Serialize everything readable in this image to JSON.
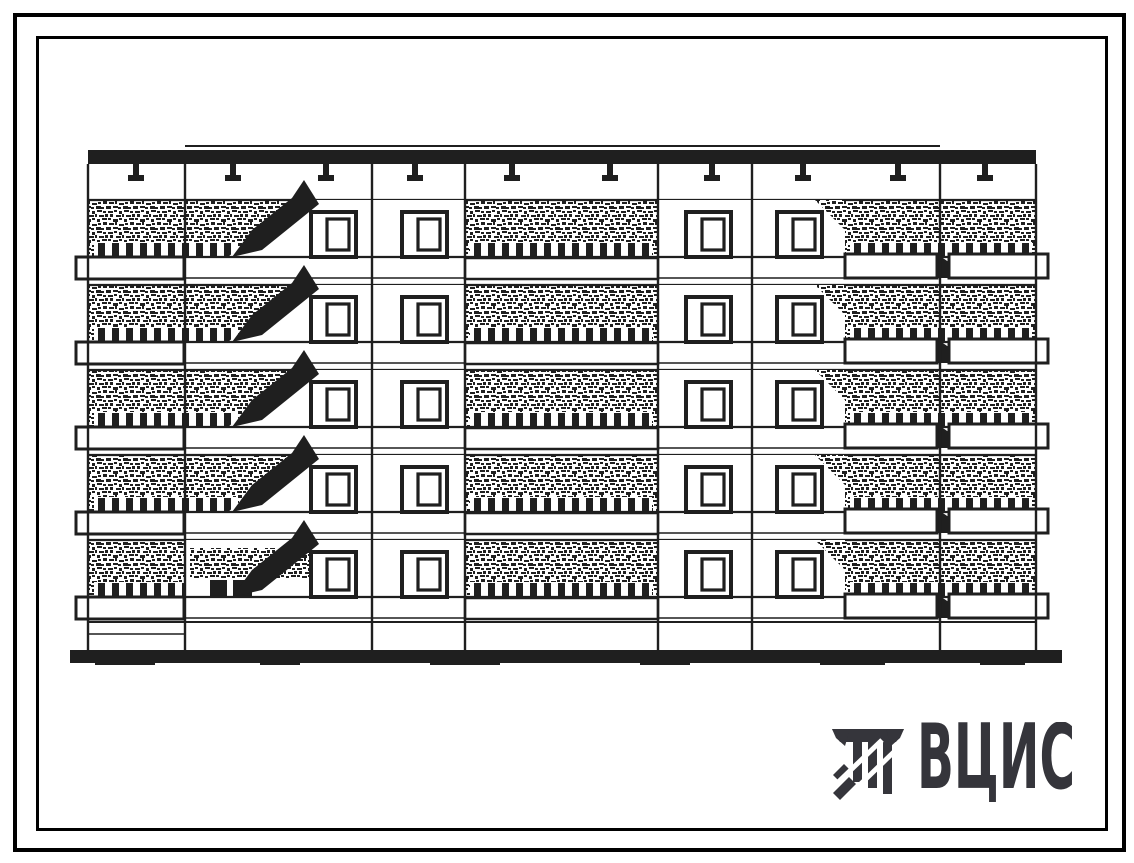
{
  "document": {
    "background": "#ffffff",
    "ink_color": "#1f1f1f",
    "frame_color": "#000000",
    "description": "Scanned facade elevation drawing of a 5-storey large-panel residential building block-section"
  },
  "elevation": {
    "floors": 5,
    "left": 88,
    "right": 1036,
    "roof_top": 150,
    "roof_band_height": 14,
    "raised_parapet_line": {
      "x1": 185,
      "x2": 940,
      "y": 146
    },
    "wall_top": 200,
    "floor_pitch": 85,
    "stipple_height": 57,
    "slab_thin_line_offset": 78,
    "basement_line_y": 622,
    "left_bay_plinth_line_y": 634,
    "wall_bottom": 650,
    "ground": {
      "left": 70,
      "right": 1062,
      "top": 650,
      "height": 13
    },
    "section_lines_x": [
      88,
      185,
      372,
      465,
      658,
      752,
      940,
      1036
    ],
    "vents_x": [
      136,
      233,
      326,
      415,
      512,
      610,
      712,
      803,
      898,
      985
    ],
    "window_columns_x": [
      311,
      402,
      686,
      777
    ],
    "window": {
      "width": 45,
      "height": 45,
      "offset_y": 12
    },
    "baluster_strips": [
      [
        94,
        238
      ],
      [
        470,
        652
      ],
      [
        850,
        1032
      ]
    ],
    "white_window_band": {
      "left": 658,
      "right": 845
    },
    "stair_bay": {
      "left": 185,
      "right": 372,
      "white_from_top_x": 296,
      "white_from_bottom_x": 228
    },
    "loggia_bay": {
      "left": 465,
      "right": 658
    },
    "left_balcony_slab": {
      "left": 76,
      "right": 184
    },
    "right_balcony": {
      "left": 845,
      "split": 937,
      "right": 1048
    },
    "entrance": {
      "streak": [
        190,
        548,
        128,
        30
      ],
      "posts": [
        [
          210,
          580,
          17,
          16
        ],
        [
          233,
          580,
          19,
          16
        ]
      ]
    }
  },
  "logo": {
    "text": "ВЦИС",
    "color": "#35353b"
  }
}
